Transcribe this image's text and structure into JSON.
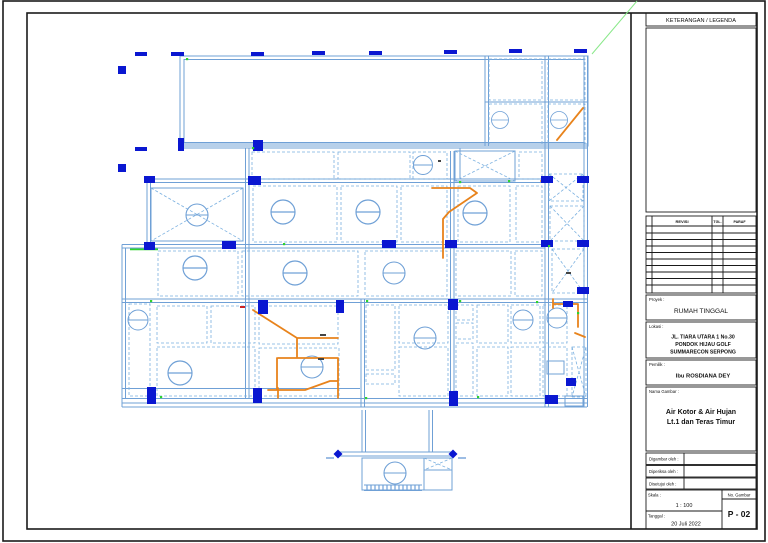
{
  "sheet": {
    "legend_title": "KETERANGAN / LEGENDA",
    "revision_table": {
      "headers": [
        "REVISI",
        "TGL.",
        "PARAF"
      ]
    },
    "project": {
      "label": "Proyek :",
      "value": "RUMAH TINGGAL"
    },
    "location": {
      "label": "Lokasi :",
      "lines": [
        "JL. TIARA UTARA 1 No.30",
        "PONDOK HIJAU GOLF",
        "SUMMARECON  SERPONG"
      ]
    },
    "owner": {
      "label": "Pemilik :",
      "value": "Ibu ROSDIANA DEY"
    },
    "drawing_name": {
      "label": "Nama Gambar :",
      "lines": [
        "Air Kotor & Air Hujan",
        "Lt.1 dan Teras Timur"
      ]
    },
    "sign_rows": [
      {
        "label": "Digambar oleh :"
      },
      {
        "label": "Diperiksa oleh :"
      },
      {
        "label": "Disetujui oleh :"
      }
    ],
    "scale": {
      "label": "Skala :",
      "value": "1 : 100"
    },
    "date": {
      "label": "Tanggal :",
      "value": "20 Juli 2022"
    },
    "number": {
      "label": "No. Gambar",
      "value": "P - 02"
    }
  },
  "plan": {
    "symbols": {
      "floor_drain": "circle-with-horizontal-line",
      "hatch": "diagonal-cross-area"
    }
  },
  "colors": {
    "paper": "#ffffff",
    "frame": "#1a1a1a",
    "wall_blue": "#6fa0d6",
    "column_blue": "#0a17d1",
    "pipe_orange": "#e8831c",
    "leader_green": "#2ed32e"
  }
}
